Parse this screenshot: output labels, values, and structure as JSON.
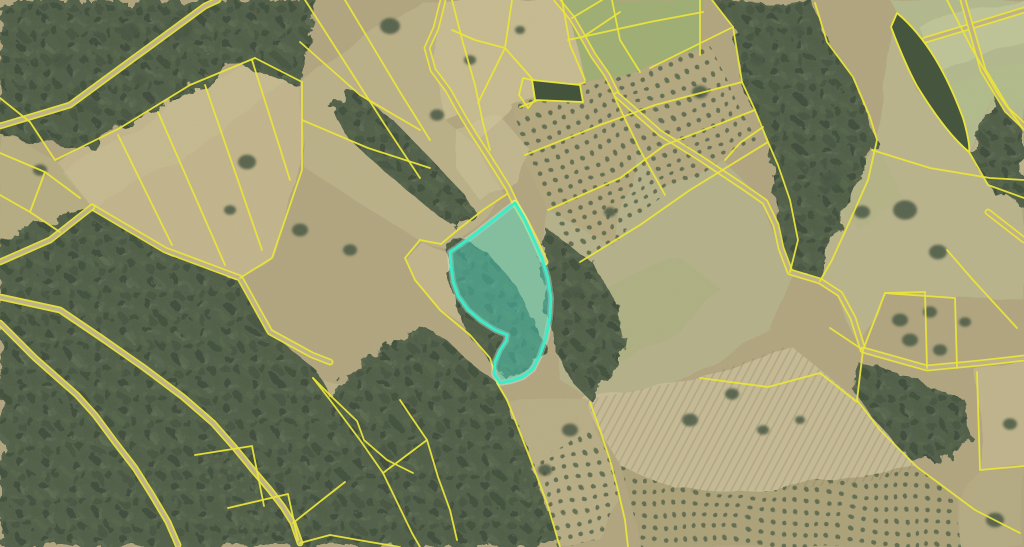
{
  "app": {
    "type": "cadastral-map-viewer",
    "description": "Aerial orthophoto with yellow cadastral parcel boundaries and one selected parcel highlighted in turquoise"
  },
  "map": {
    "width": 1024,
    "height": 547,
    "colors": {
      "base_field": "#b0a47c",
      "parcel_line": "#e9e43b",
      "road_fill": "#bdb289",
      "forest": "#465640",
      "highlight_stroke": "#3bedc6",
      "highlight_fill": "rgba(77,222,198,0.45)",
      "highlight_glow": "rgba(220,255,240,0.35)"
    },
    "fields": [
      {
        "d": "M55,160 L120,128 L190,85 L255,58 L302,82 L302,165 L272,255 L240,278 L165,250 L92,207 Z",
        "fill": "#c3b58a"
      },
      {
        "d": "M0,128 L30,145 L55,160 L92,207 L60,232 L0,250 Z",
        "fill": "#b6ab7f"
      },
      {
        "d": "M298,82 L420,0 L445,0 L432,55 L445,120 L478,147 L505,195 L452,248 L420,240 L360,205 L305,168 Z",
        "fill": "#bbaf85"
      },
      {
        "d": "M443,0 L562,0 L585,80 L520,107 L478,145 L460,112 L444,118 L430,58 Z",
        "fill": "#c8bb8f"
      },
      {
        "d": "M562,0 L705,0 L700,58 L640,73 L586,82 Z",
        "fill": "#9cad6e"
      },
      {
        "d": "M515,108 L584,84 L648,70 L712,48 L742,110 L756,140 L700,178 L650,212 L612,245 L582,265 L550,215 L525,160 Z",
        "fill": "#b3a77c"
      },
      {
        "d": "M548,210 L612,245 L640,150 L668,192 L725,162 L762,200 L780,250 L790,272 L770,330 L720,360 L660,390 L620,408 L590,400 L560,380 L551,320 L543,258 Z",
        "fill": "#b5b087"
      },
      {
        "d": "M790,272 L830,285 L863,350 L885,293 L957,298 L1024,300 L1024,132 L998,96 L968,152 L915,88 L895,15 L875,140 L825,230 Z",
        "fill": "#bab38a"
      },
      {
        "d": "M890,0 L1024,0 L1024,130 L998,94 L968,150 L915,85 L897,13 Z",
        "fill": "#b2b98c"
      },
      {
        "d": "M585,400 L700,378 L790,345 L857,400 L917,467 L880,480 L780,490 L680,492 L620,465 Z",
        "fill": "#c7bb94"
      },
      {
        "d": "M620,465 L680,492 L780,490 L880,472 L917,467 L958,500 L960,547 L640,547 Z",
        "fill": "#aba076"
      },
      {
        "d": "M313,378 L420,398 L427,440 L383,473 L360,440 L330,400 Z",
        "fill": "#bbaf85"
      },
      {
        "d": "M420,240 L450,252 L455,290 L470,312 L483,322 L470,330 L440,310 L415,280 L405,258 Z",
        "fill": "#c1b389"
      },
      {
        "d": "M977,372 L1024,360 L1024,465 L980,470 Z",
        "fill": "#c0b48a"
      },
      {
        "d": "M980,470 L1024,465 L1024,547 L960,547 L960,500 Z",
        "fill": "#b5a97f"
      },
      {
        "d": "M507,400 L590,402 L610,460 L618,500 L600,540 L560,547 L530,520 L515,460 Z",
        "fill": "#b8ac82"
      }
    ],
    "tints": [
      {
        "d": "M920,28 L1024,0 L1024,40 L940,70 Z",
        "fill": "rgba(210,215,165,0.40)"
      },
      {
        "d": "M940,90 L1024,58 L1024,100 L962,126 Z",
        "fill": "rgba(175,190,130,0.45)"
      },
      {
        "d": "M560,300 L620,278 L680,258 L722,290 L680,330 L620,360 L576,340 Z",
        "fill": "rgba(160,175,115,0.35)"
      },
      {
        "d": "M835,160 L880,150 L905,200 L860,230 L830,200 Z",
        "fill": "rgba(170,180,120,0.30)"
      },
      {
        "d": "M455,128 L502,118 L530,150 L520,185 L480,200 L456,168 Z",
        "fill": "rgba(210,200,155,0.50)"
      },
      {
        "d": "M60,170 L120,140 L190,95 L250,62 L285,80 L230,120 L150,180 L95,210 Z",
        "fill": "rgba(205,195,150,0.35)"
      }
    ],
    "forests": [
      "M0,0 L318,0 L300,85 L240,65 L160,105 L80,150 L0,135 Z",
      "M0,238 L92,207 L168,252 L242,280 L272,334 L318,372 L332,402 L362,442 L386,475 L413,533 L420,547 L0,547 Z",
      "M330,400 L360,440 L383,473 L412,533 L420,547 L560,547 L547,503 L528,453 L517,425 L507,400 L497,383 L470,363 L445,338 L420,328 L393,344 L358,364 L335,384 Z",
      "M352,88 L395,122 L430,158 L460,190 L475,212 L455,228 L425,205 L385,172 L348,138 L332,110 Z",
      "M460,235 L490,255 L515,285 L535,320 L545,350 L530,370 L505,378 L488,360 L470,335 L455,305 L448,275 L448,252 Z",
      "M548,230 L590,260 L615,300 L625,345 L610,372 L590,400 L570,380 L552,340 L545,295 L540,258 Z",
      "M712,0 L815,3 L827,42 L853,77 L870,117 L877,140 L860,180 L838,228 L820,280 L790,272 L780,245 L768,142 L755,110 L742,82 L733,27 Z",
      "M1024,132 L998,96 L970,152 L992,192 L1024,205 Z",
      "M858,362 L920,380 L965,400 L975,440 L940,462 L905,455 L875,420 L855,392 Z"
    ],
    "orchards": [
      {
        "d": "M515,108 L584,84 L648,70 L712,48 L742,110 L756,140 L700,178 L650,212 L612,245 L582,265 L550,215 L525,160 Z",
        "p": "a"
      },
      {
        "d": "M620,465 L680,492 L780,490 L880,472 L917,467 L958,500 L960,547 L640,547 Z",
        "p": "b"
      },
      {
        "d": "M515,462 L560,450 L598,432 L612,462 L618,500 L600,540 L562,547 L530,520 Z",
        "p": "c"
      },
      {
        "d": "M195,455 L252,446 L264,506 L224,518 Z",
        "p": "c"
      },
      {
        "d": "M228,508 L288,494 L298,540 L240,547 Z",
        "p": "c"
      }
    ],
    "plow_fields": [
      {
        "d": "M585,400 L700,378 L790,345 L857,400 L917,467 L880,480 L780,490 L680,492 L620,465 Z"
      }
    ],
    "tree_clumps": [
      [
        180,
        28,
        13
      ],
      [
        390,
        26,
        10
      ],
      [
        247,
        162,
        9
      ],
      [
        437,
        115,
        7
      ],
      [
        470,
        60,
        6
      ],
      [
        520,
        30,
        5
      ],
      [
        575,
        292,
        8
      ],
      [
        610,
        212,
        6
      ],
      [
        700,
        92,
        8
      ],
      [
        757,
        60,
        7
      ],
      [
        797,
        30,
        6
      ],
      [
        830,
        180,
        10
      ],
      [
        862,
        212,
        8
      ],
      [
        905,
        210,
        12
      ],
      [
        938,
        252,
        9
      ],
      [
        900,
        320,
        8
      ],
      [
        930,
        312,
        7
      ],
      [
        910,
        340,
        8
      ],
      [
        940,
        350,
        7
      ],
      [
        965,
        322,
        6
      ],
      [
        690,
        420,
        8
      ],
      [
        732,
        394,
        7
      ],
      [
        763,
        430,
        6
      ],
      [
        800,
        420,
        5
      ],
      [
        995,
        520,
        9
      ],
      [
        1010,
        424,
        7
      ],
      [
        570,
        430,
        8
      ],
      [
        545,
        470,
        7
      ],
      [
        90,
        105,
        8
      ],
      [
        140,
        80,
        7
      ],
      [
        60,
        60,
        9
      ],
      [
        300,
        230,
        8
      ],
      [
        350,
        250,
        7
      ],
      [
        230,
        210,
        6
      ],
      [
        130,
        30,
        9
      ],
      [
        40,
        170,
        7
      ]
    ],
    "roads": [
      "M0,126 L70,105 L145,50 L205,6 L218,0",
      "M443,0 L436,28 L427,48 L433,70 L448,90 L462,115 L473,133 L486,153 L498,172 L508,188 L515,203",
      "M515,203 L526,222 L536,242 L545,262",
      "M92,207 L165,250 L240,278 L270,332 L312,355 L330,362",
      "M0,262 L50,240 L92,207",
      "M557,0 L572,18 L583,37 L593,55 L607,75 L617,95",
      "M617,95 L660,133 L700,158 L745,188 L765,202 L776,225 L781,248 L790,272 L820,281 L840,294 L853,318 L863,350",
      "M863,350 L927,368 L980,363 L1024,358",
      "M925,40 L975,25 L1024,10",
      "M963,0 L983,70 L1007,110 L1024,126",
      "M988,212 L1024,240",
      "M0,297 L60,310 L100,337 L143,367 L183,397 L213,423 L235,448 L253,470 L270,490 L283,507 L293,523 L300,543",
      "M0,323 L35,358 L77,395 L95,415 L115,442 L135,468 L152,495 L168,522 L178,545"
    ],
    "parcel_lines": [
      "M55,160 L120,128 L190,85 L255,58",
      "M0,98 L30,122 L55,160",
      "M118,135 L172,245",
      "M158,112 L225,265",
      "M205,85 L262,250",
      "M252,60 L290,180",
      "M255,58 L302,82",
      "M302,82 L302,170 L272,258 L240,278",
      "M0,153 L45,172 L80,198",
      "M45,172 L30,212 L60,232",
      "M0,195 L30,212",
      "M305,0 L385,125 L420,178",
      "M345,0 L400,92 L430,140",
      "M300,42 L360,95 L420,130",
      "M302,120 L368,148 L430,168",
      "M452,0 L463,43 L475,85 L483,123 L490,150",
      "M478,103 L505,48 L512,0",
      "M505,48 L475,40 L452,30",
      "M505,48 L535,82",
      "M572,18 L602,0",
      "M583,37 L620,12",
      "M562,0 L570,45 L585,80",
      "M612,0 L620,40 L640,72",
      "M568,40 L650,22 L703,12",
      "M700,0 L700,55",
      "M520,107 L585,82",
      "M525,155 L600,125 L655,105 L742,82",
      "M548,210 L620,178 L665,145 L755,110",
      "M580,262 L640,225 L690,190 L768,142",
      "M615,98 L640,150 L665,195",
      "M650,68 L733,27",
      "M712,0 L733,27 L742,82 L755,110 L768,142 L778,165 L790,200 L798,240 L790,272",
      "M815,3 L827,42 L853,77 L870,117 L877,140 L868,180 L848,225 L832,260 L820,281",
      "M763,127 L740,143 L725,160",
      "M947,0 L970,45 L998,94 L1024,130",
      "M1024,198 L988,185 L968,150",
      "M872,150 L930,168 L990,178 L1024,180",
      "M947,250 L973,280 L1017,328",
      "M863,350 L885,293 L925,292",
      "M885,293 L955,298 L957,368",
      "M925,292 L927,368",
      "M830,328 L863,350",
      "M857,400 L880,430 L917,467 L975,510 L1020,533",
      "M863,350 L857,400",
      "M977,372 L980,470 L1024,466",
      "M313,378 L330,400 L360,440 L383,473 L412,533 L420,547",
      "M313,378 L333,398 L357,421 L364,440 L387,460 L413,473",
      "M400,400 L410,415 L427,440 L438,477 L450,510 L457,540",
      "M427,440 L383,473",
      "M507,400 L517,425 L528,453 L547,503 L560,547",
      "M497,383 L507,400",
      "M590,402 L600,430 L610,460 L618,490 L625,520 L628,547",
      "M700,378 L768,387 L820,373 L857,402",
      "M507,194 L483,210 L460,228 L441,244",
      "M441,244 L420,240",
      "M420,240 L405,258 L415,280 L440,310 L470,335 L490,358 L497,381",
      "M195,455 L252,446 L264,506",
      "M228,508 L288,494 L298,540",
      "M293,523 L322,500 L345,482",
      "M300,543 L330,535 L370,542 L400,547"
    ],
    "closed_parcels": [
      {
        "d": "M532,80 L580,85 L583,102 L535,100 Z",
        "fill": "#44543c"
      },
      {
        "d": "M523,78 L532,80 L535,100 L528,108 L519,95 Z",
        "fill": "none"
      },
      {
        "d": "M897,13 C927,38 947,75 963,118 C968,135 970,148 969,152 C952,138 933,112 917,86 C905,64 896,40 891,27 Z",
        "fill": "#46563e"
      }
    ],
    "highlight": {
      "d": "M515,203 L524,218 L533,238 L542,258 L548,278 L551,298 L550,318 L546,338 L540,355 L533,369 L523,377 L511,381 L500,383 L494,374 L495,362 L500,350 L506,341 L507,335 L495,330 L481,321 L468,310 L458,296 L453,282 L451,266 L450,252 L470,238 L492,221 L507,209 Z"
    }
  }
}
